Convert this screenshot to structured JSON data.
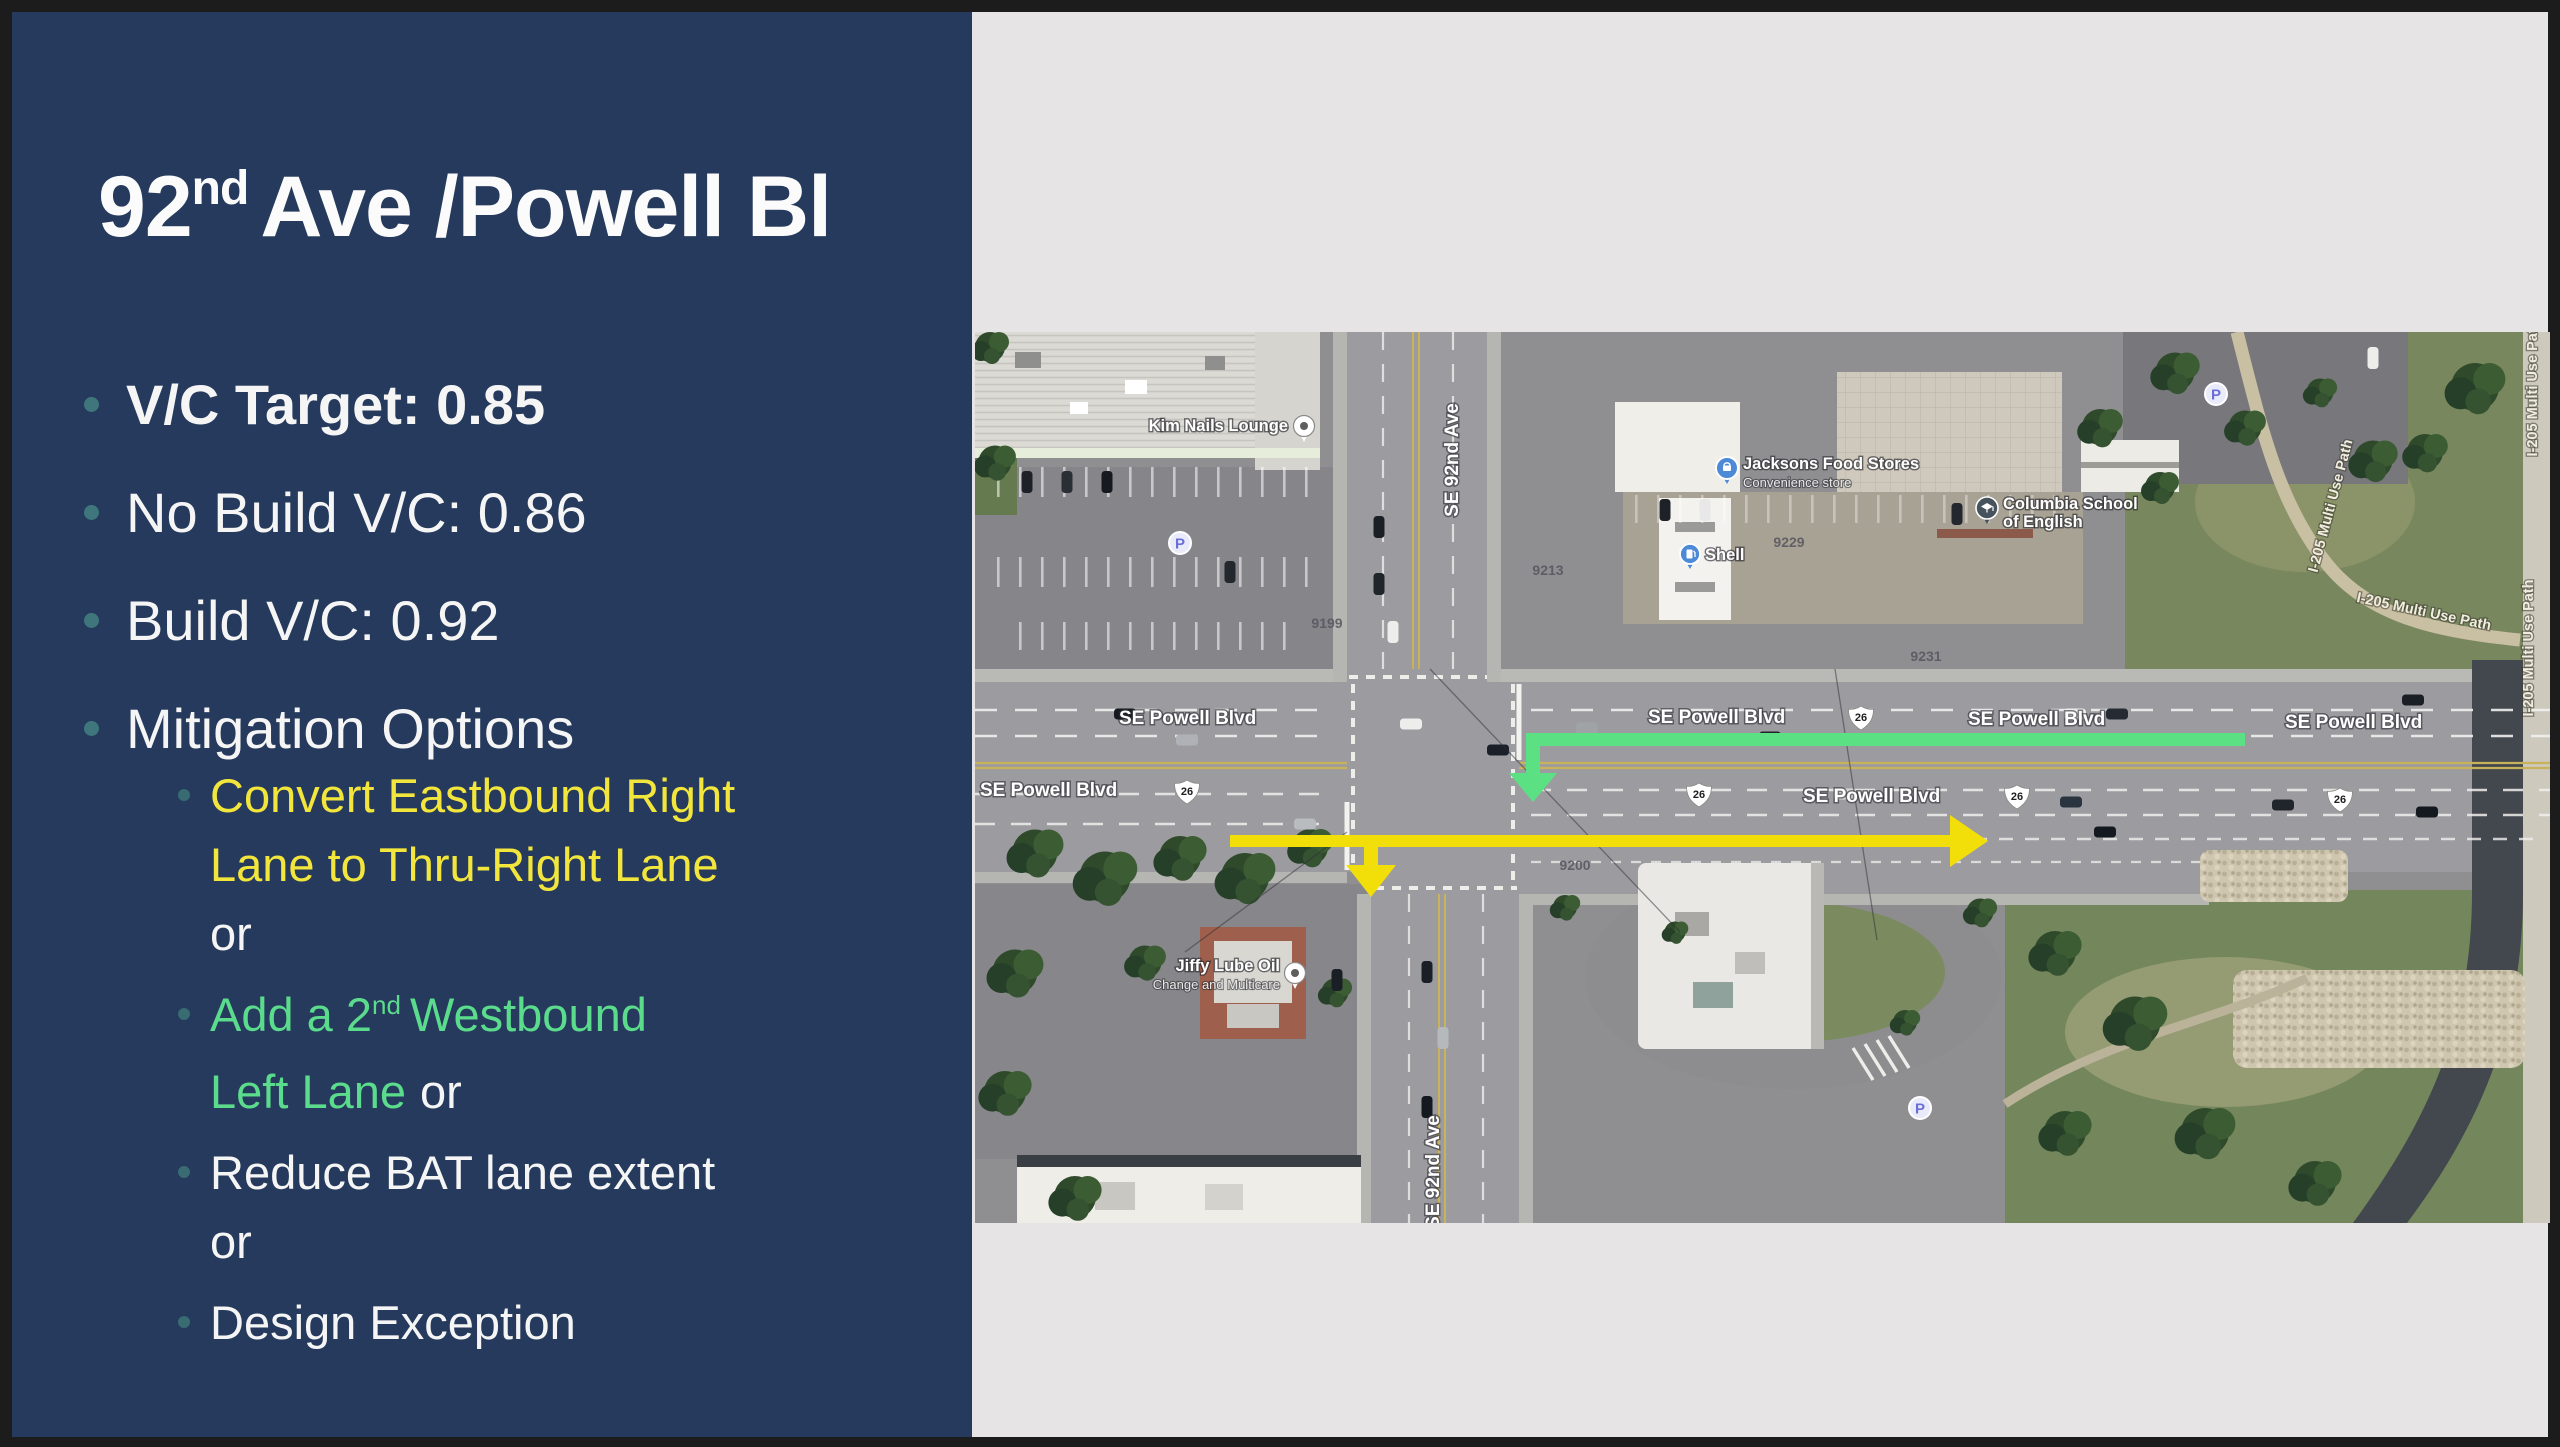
{
  "slide": {
    "title": {
      "number": "92",
      "ordinal": "nd",
      "rest": "Ave /Powell Bl"
    },
    "bullets": [
      {
        "label": "V/C Target: 0.85"
      },
      {
        "label": "No Build V/C: 0.86"
      },
      {
        "label": "Build V/C: 0.92"
      },
      {
        "label": "Mitigation Options"
      }
    ],
    "mitigation": {
      "option1": {
        "line1": "Convert Eastbound Right",
        "line2": "Lane to Thru-Right Lane",
        "conj": "or"
      },
      "option2": {
        "pre": "Add a 2",
        "ordinal": "nd",
        "post": "Westbound",
        "line2": "Left Lane",
        "conj": "or"
      },
      "option3": {
        "line1": "Reduce BAT lane extent",
        "conj": "or"
      },
      "option4": {
        "line1": "Design Exception"
      }
    }
  },
  "map": {
    "streets": {
      "powell": "SE Powell Blvd",
      "ave92": "SE 92nd Ave",
      "route": "26",
      "path205": "I-205 Multi Use Path"
    },
    "pois": {
      "kim": "Kim Nails Lounge",
      "jacksons": "Jacksons Food Stores",
      "jacksons_sub": "Convenience store",
      "shell": "Shell",
      "columbia_line1": "Columbia School",
      "columbia_line2": "of English",
      "jiffy_line1": "Jiffy Lube Oil",
      "jiffy_line2": "Change and Multicare",
      "parking": "P"
    },
    "house_numbers": {
      "a": "9229",
      "b": "9231",
      "c": "9213",
      "d": "9200",
      "e": "9199"
    },
    "arrows": {
      "green": {
        "color": "#5CE084",
        "meaning": "westbound add 2nd left lane"
      },
      "yellow": {
        "color": "#F2DF0A",
        "meaning": "eastbound thru-right conversion"
      }
    }
  },
  "theme": {
    "navy": "#253A5C",
    "panel_edge": "#9FAECB",
    "canvas_bg": "#E6E4E5",
    "frame": "#1C1C1C",
    "bullet_dot": "#3E767C",
    "yellow_text": "#F2E63C",
    "green_text": "#5BDB8C",
    "white_text": "#F5F5F5"
  }
}
